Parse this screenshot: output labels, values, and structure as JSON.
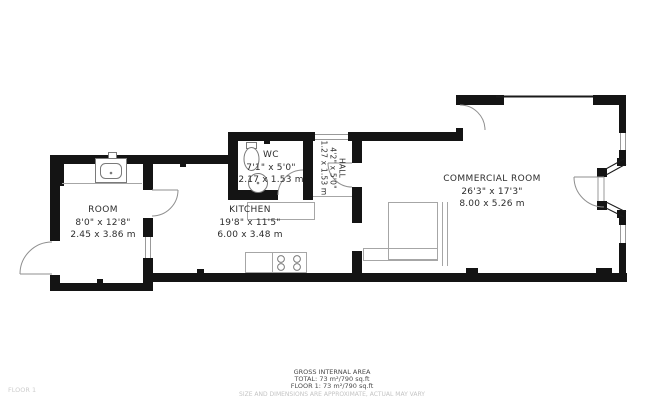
{
  "floorplan": {
    "rooms": [
      {
        "name": "ROOM",
        "dims_imperial": "8'0\" x 12'8\"",
        "dims_metric": "2.45 x 3.86 m"
      },
      {
        "name": "WC",
        "dims_imperial": "7'1\" x 5'0\"",
        "dims_metric": "2.17 x 1.53 m"
      },
      {
        "name": "HALL",
        "dims_imperial": "4'2\" x 5'0\"",
        "dims_metric": "1.27 x 1.53 m"
      },
      {
        "name": "KITCHEN",
        "dims_imperial": "19'8\" x 11'5\"",
        "dims_metric": "6.00 x 3.48 m"
      },
      {
        "name": "COMMERCIAL ROOM",
        "dims_imperial": "26'3\" x 17'3\"",
        "dims_metric": "8.00 x 5.26 m"
      }
    ],
    "footer": {
      "area_title": "GROSS INTERNAL AREA",
      "area_total": "TOTAL: 73 m²/790 sq.ft",
      "area_floor": "FLOOR 1: 73 m²/790 sq.ft",
      "disclaimer": "SIZE AND DIMENSIONS ARE APPROXIMATE, ACTUAL MAY VARY",
      "floor_label": "FLOOR 1"
    },
    "colors": {
      "wall": "#141414",
      "thin_line": "#999999",
      "text": "#2d2d2d",
      "muted": "#c4c4c4"
    }
  }
}
